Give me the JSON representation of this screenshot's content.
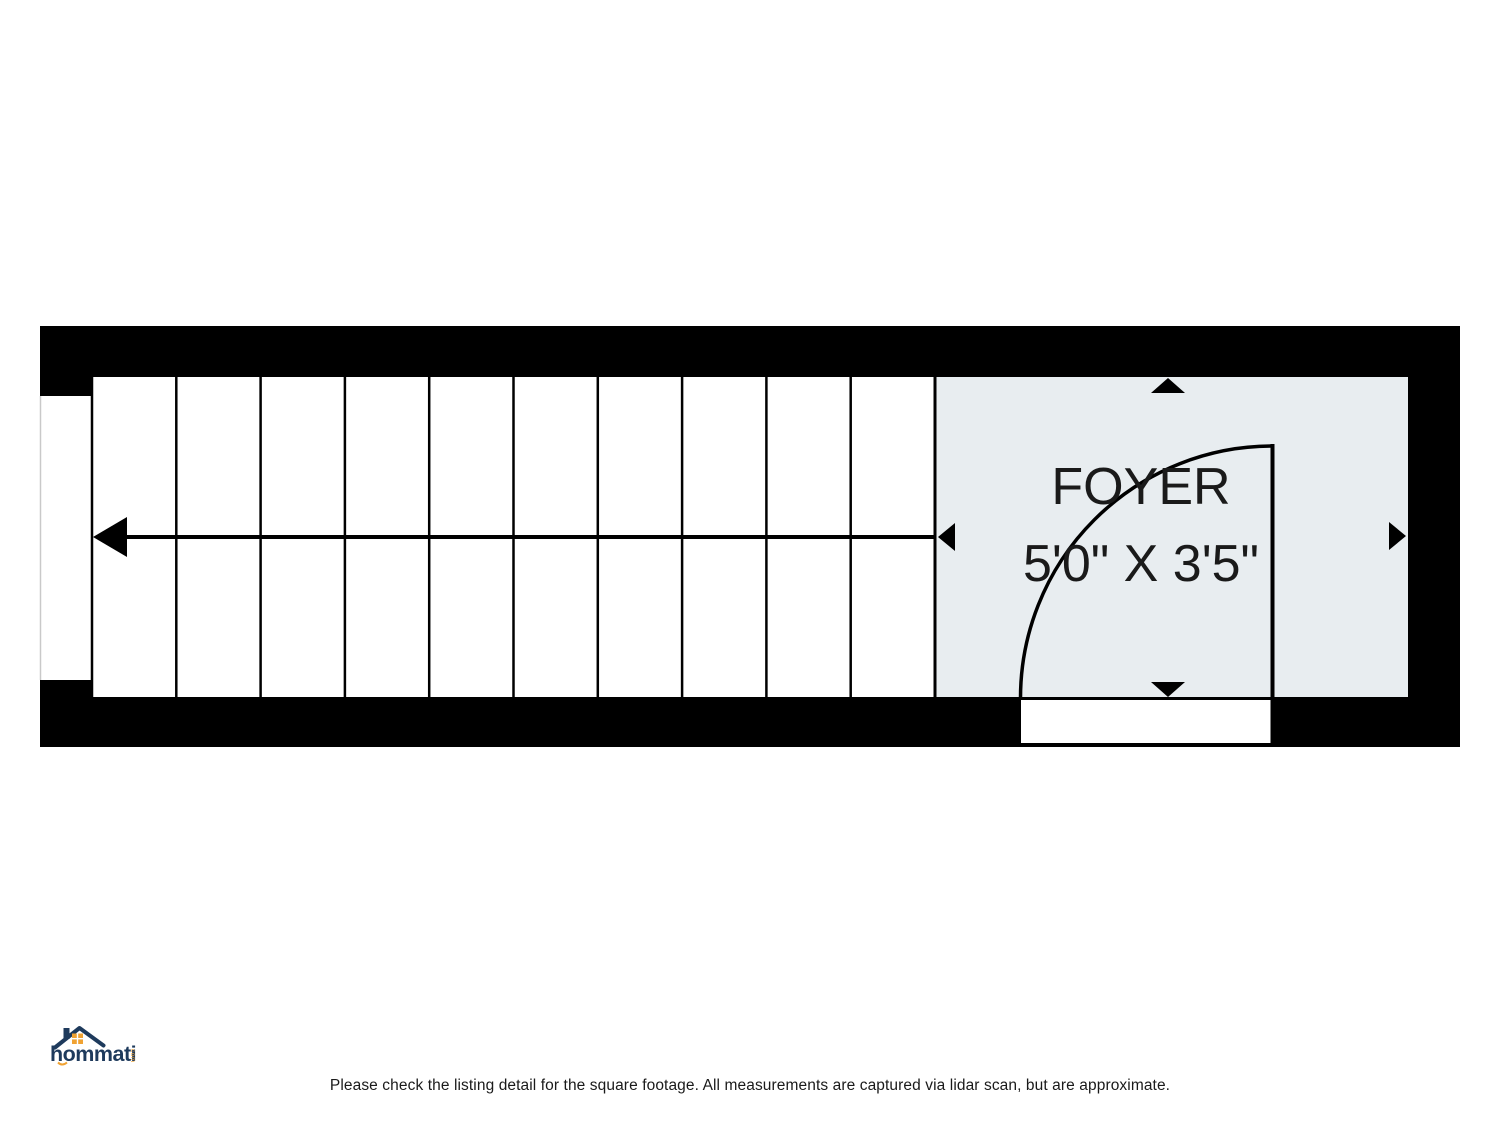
{
  "floor_plan": {
    "room": {
      "name": "FOYER",
      "dimensions": "5'0\" X 3'5\"",
      "fill_color": "#e8edf0",
      "wall_color": "#000000",
      "label_color": "#1a1a1a"
    },
    "stairs": {
      "tread_count": 10,
      "direction": "left"
    }
  },
  "logo": {
    "brand": "hommati",
    "suffix": "com",
    "colors": {
      "navy": "#1e3a5c",
      "orange": "#f0a232"
    }
  },
  "footer": {
    "disclaimer": "Please check the listing detail for the square footage. All measurements are captured via lidar scan, but are approximate."
  }
}
